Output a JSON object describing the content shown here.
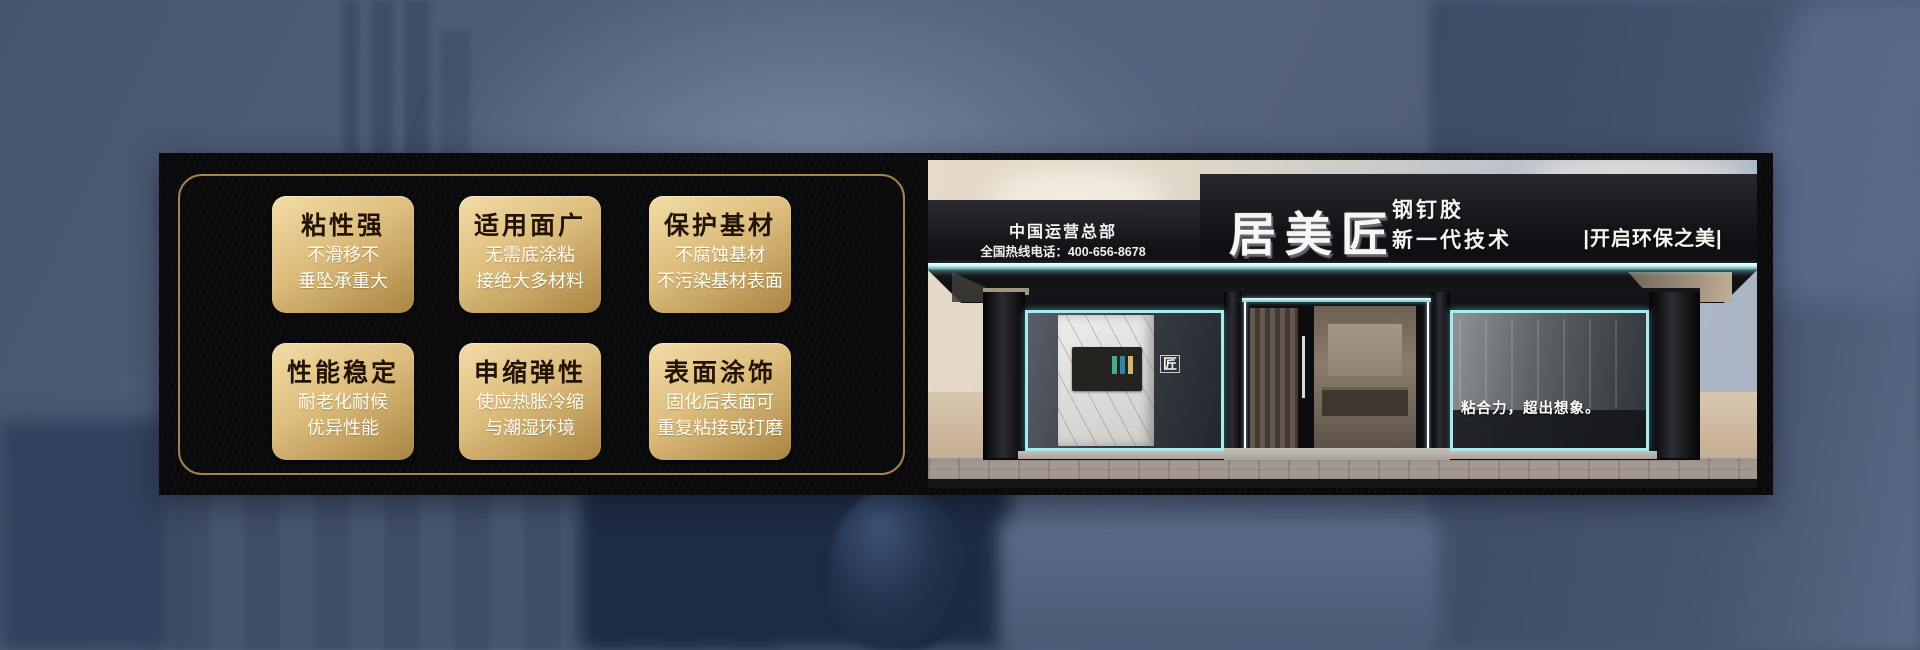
{
  "left_panel": {
    "cards": [
      {
        "title": "粘性强",
        "line1": "不滑移不",
        "line2": "垂坠承重大"
      },
      {
        "title": "适用面广",
        "line1": "无需底涂粘",
        "line2": "接绝大多材料"
      },
      {
        "title": "保护基材",
        "line1": "不腐蚀基材",
        "line2": "不污染基材表面"
      },
      {
        "title": "性能稳定",
        "line1": "耐老化耐候",
        "line2": "优异性能"
      },
      {
        "title": "申缩弹性",
        "line1": "使应热胀冷缩",
        "line2": "与潮湿环境"
      },
      {
        "title": "表面涂饰",
        "line1": "固化后表面可",
        "line2": "重复粘接或打磨"
      }
    ]
  },
  "storefront": {
    "hq_label": "中国运营总部",
    "hotline": "全国热线电话：400-656-8678",
    "brand": "居美匠",
    "product": "钢钉胶",
    "tagline": "新一代技术",
    "sign_slogan": "|开启环保之美|",
    "window_slogan": "粘合力，超出想象。",
    "logo_glyph": "匠"
  },
  "colors": {
    "accent_gold_border": "#a5834d",
    "card_gradient_top": "#f2dca7",
    "card_gradient_bottom": "#a98442",
    "card_title_text": "#221407",
    "card_body_text": "#fffdf4",
    "led_cyan": "#a6ebee",
    "banner_black": "#0a0a0c",
    "background_slate_blue": "#53617d"
  }
}
